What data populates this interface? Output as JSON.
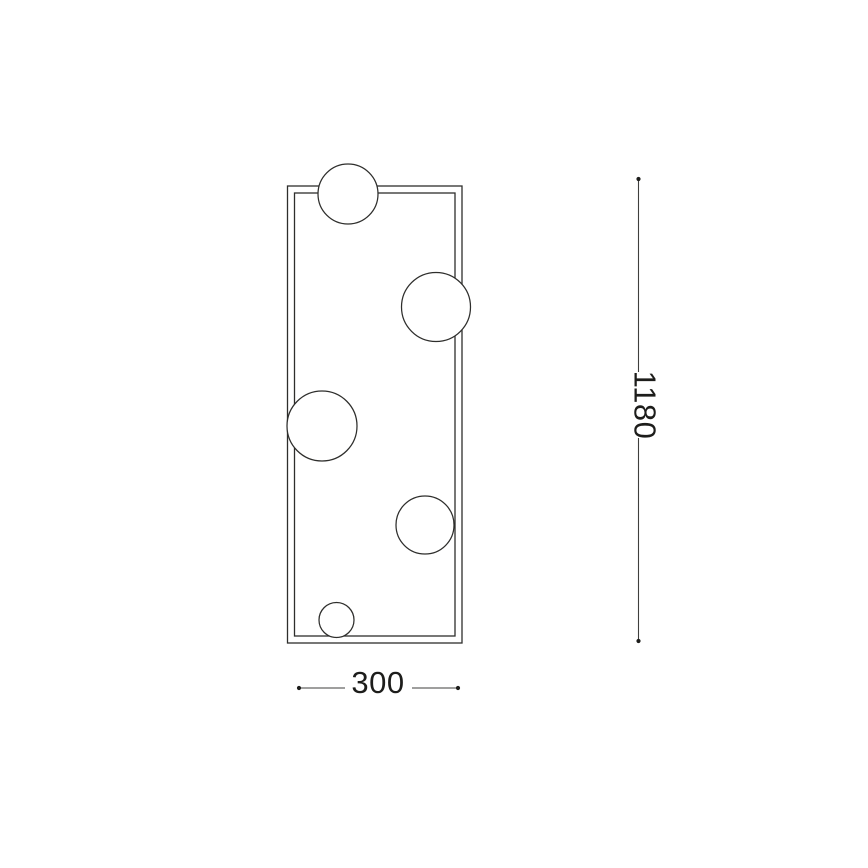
{
  "diagram": {
    "kind": "product-dimension-drawing",
    "view": "front-elevation",
    "colors": {
      "bg": "#ffffff",
      "frame": "#2e2e2c",
      "dim": "#3f3f3d",
      "text": "#1d1d1b"
    },
    "frame": {
      "style": "double-outline-rectangle",
      "spheres_count": 5
    },
    "dimensions": {
      "height": {
        "label": "1180",
        "orientation": "vertical",
        "text_rotation_deg": 90
      },
      "width": {
        "label": "300",
        "orientation": "horizontal"
      }
    }
  }
}
